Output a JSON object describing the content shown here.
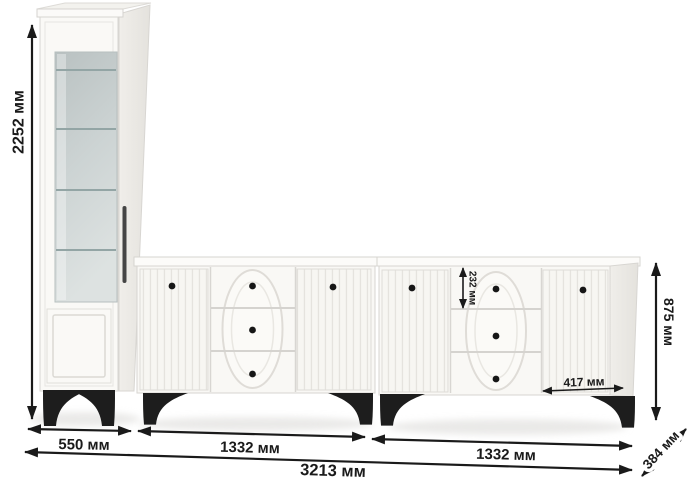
{
  "diagram": {
    "type": "furniture-dimension-drawing",
    "units": "мм"
  },
  "dimensions": {
    "cabinet_height": "2252 мм",
    "cabinet_width": "550 мм",
    "sideboard_left_width": "1332 мм",
    "sideboard_right_width": "1332 мм",
    "total_width": "3213 мм",
    "sideboard_height": "875 мм",
    "top_drawer_height": "232 мм",
    "right_door_width": "417 мм",
    "depth": "384 мм"
  },
  "colors": {
    "dimension_ink": "#1a1a1a",
    "furniture_body": "#f9f8f5",
    "furniture_seam": "#d7d5d1",
    "glass": "#ccd3d3",
    "hardware_black": "#1d1d1d",
    "background": "#ffffff"
  }
}
